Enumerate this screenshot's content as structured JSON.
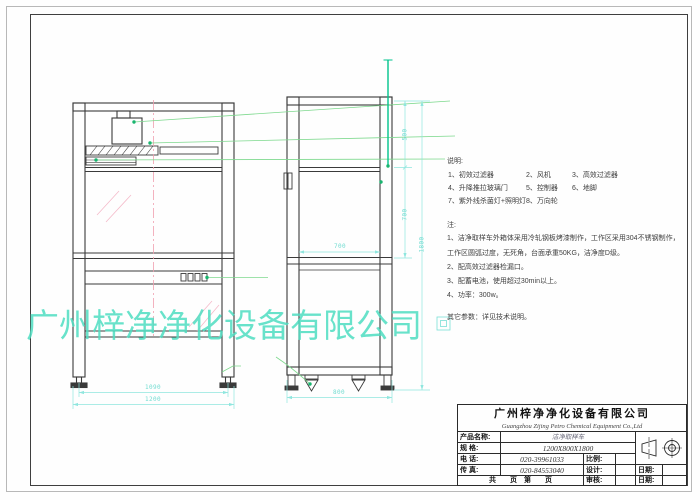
{
  "sheet": {
    "watermark": "广州梓净净化设备有限公司"
  },
  "notes": {
    "heading": "说明:",
    "parts": [
      [
        "1、初效过滤器",
        "2、风机",
        "3、高效过滤器"
      ],
      [
        "4、升降推拉玻璃门",
        "5、控制器",
        "6、地脚"
      ],
      [
        "7、紫外线杀菌灯+照明灯",
        "8、万向轮",
        ""
      ]
    ],
    "remark_heading": "注:",
    "remarks": [
      "1、洁净取样车外箱体采用冷轧钢板烤漆制作，工作区采用304不锈钢制作，",
      "工作区圆弧过度，无死角，台面承重50KG，洁净度D级。",
      "2、配高效过滤器检漏口。",
      "3、配蓄电池，使用超过30min以上。",
      "4、功率：300w。"
    ],
    "other": "其它参数：详见技术说明。"
  },
  "dims": {
    "front_inner": "1090",
    "front_outer": "1200",
    "side_depth": "800",
    "side_inner": "700",
    "height_top": "500",
    "height_mid": "700",
    "height_total": "1800"
  },
  "title_block": {
    "company_cn": "广州梓净净化设备有限公司",
    "company_en": "Guangzhou Zijing Petro Chemical Equipment Co.,Ltd",
    "product_label": "产品名称:",
    "product_value": "洁净取样车",
    "spec_label": "规  格:",
    "spec_value": "1200X800X1800",
    "tel_label": "电  话:",
    "tel_value": "020-39961033",
    "fax_label": "传  真:",
    "fax_value": "020-84553040",
    "scale_label": "比例:",
    "design_label": "设计:",
    "check_label": "审核:",
    "date_label": "日期:",
    "date2_label": "日期:",
    "pages_label": "共　　页　第　　页"
  },
  "colors": {
    "line": "#3a3a3a",
    "green_leader": "#7ed98e",
    "green_strong": "#00c48d",
    "cyan_dim": "#8fe6de",
    "red_centerline": "#f0a0b0",
    "watermark": "#4fdec1"
  }
}
